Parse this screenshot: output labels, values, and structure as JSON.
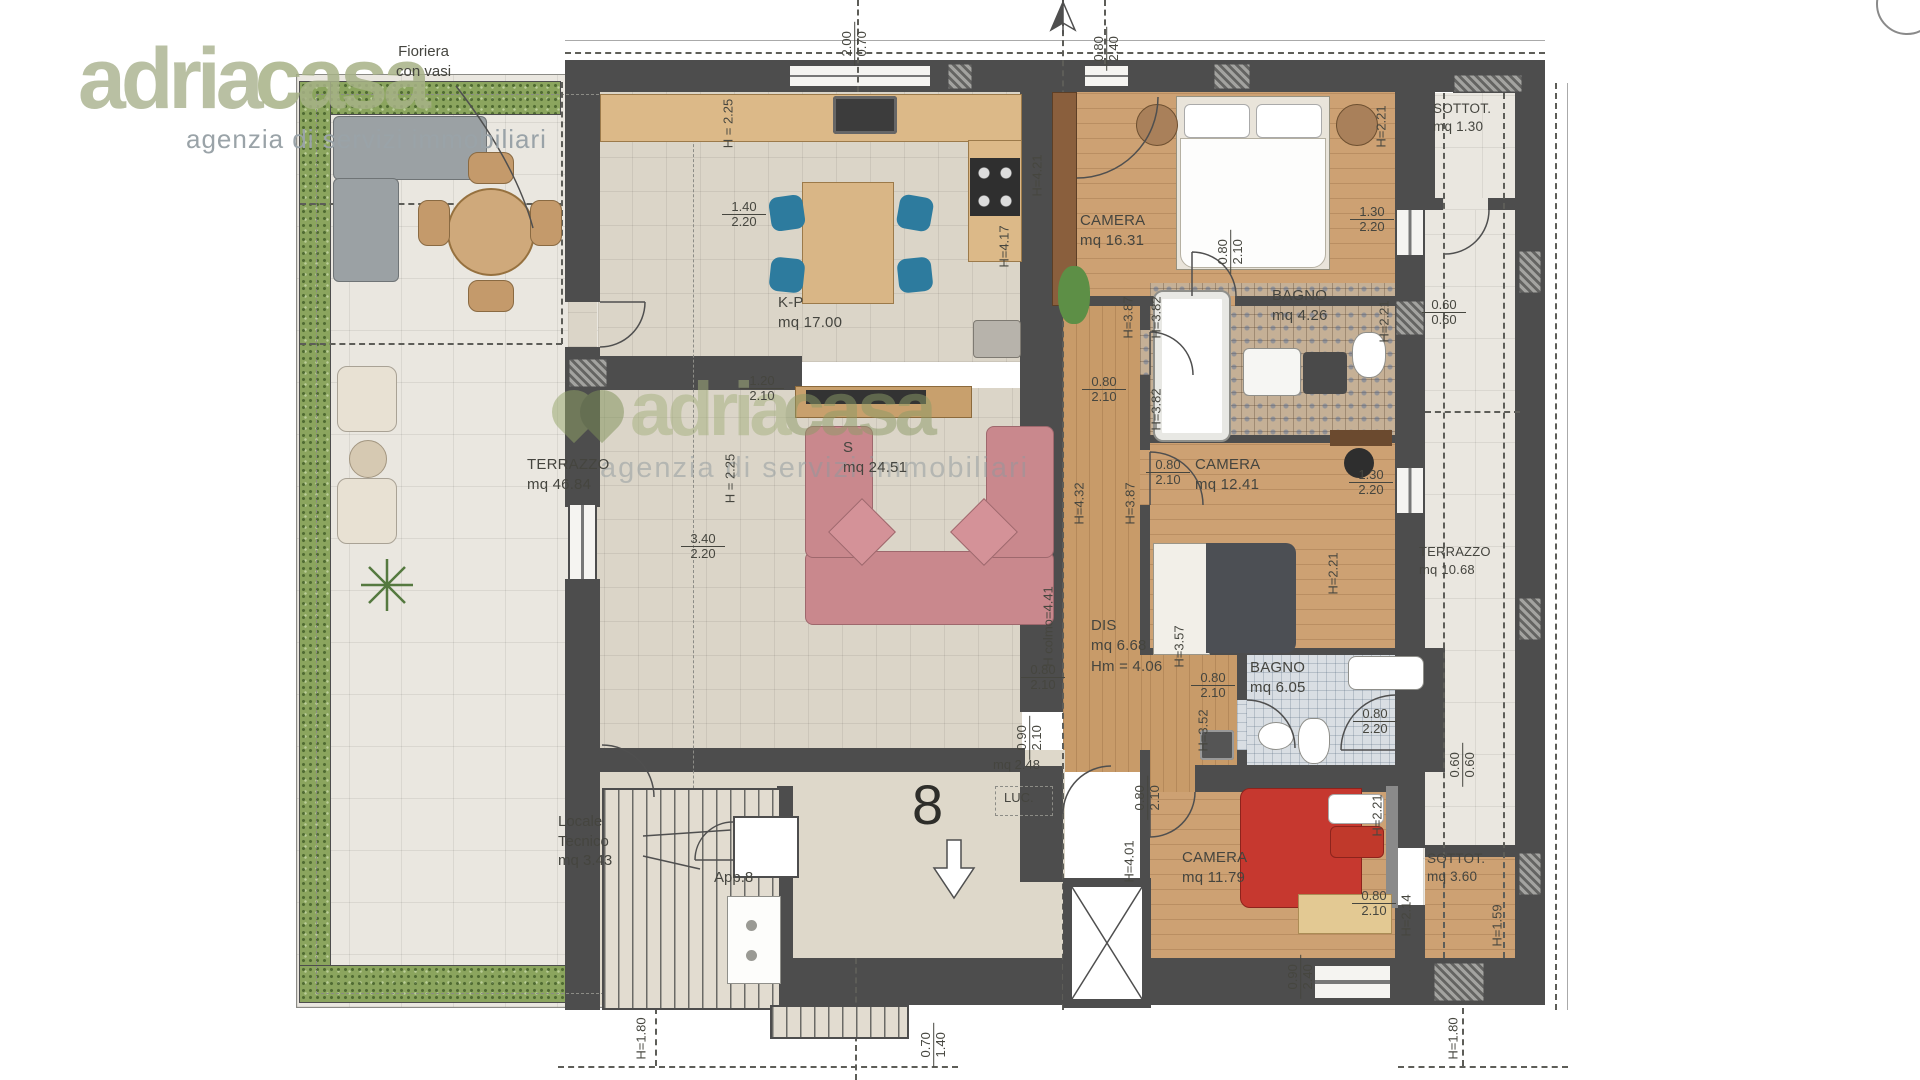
{
  "brand": {
    "name_primary": "adria",
    "name_secondary": "casa",
    "tagline": "agenzia di servizi immobiliari"
  },
  "plan": {
    "unit_number": "8",
    "rooms": {
      "terrazzo_left": {
        "name": "TERRAZZO",
        "area": "mq 46.84"
      },
      "kitchen": {
        "name": "K-P",
        "area": "mq 17.00"
      },
      "living": {
        "name": "S",
        "area": "mq 24.51"
      },
      "camera1": {
        "name": "CAMERA",
        "area": "mq 16.31"
      },
      "bagno1": {
        "name": "BAGNO",
        "area": "mq 4.26"
      },
      "sottotetto1": {
        "name": "SOTTOT.",
        "area": "mq 1.30"
      },
      "terrazzo_right": {
        "name": "TERRAZZO",
        "area": "mq 10.68"
      },
      "camera2": {
        "name": "CAMERA",
        "area": "mq 12.41"
      },
      "disimpegno": {
        "name": "DIS",
        "area": "mq 6.68",
        "height": "Hm = 4.06"
      },
      "bagno2": {
        "name": "BAGNO",
        "area": "mq 6.05"
      },
      "camera3": {
        "name": "CAMERA",
        "area": "mq 11.79"
      },
      "sottotetto2": {
        "name": "SOTTOT.",
        "area": "mq 3.60"
      }
    },
    "annotations": {
      "planter_line1": "Fioriera",
      "planter_line2": "con vasi",
      "tech_line1": "Locale",
      "tech_line2": "Tecnico",
      "tech_area": "mq 3.43",
      "apartment_ref": "App.8",
      "skylight": "LUC.",
      "stair_landing_area": "mq 2.48"
    },
    "dims": {
      "d1": {
        "a": "2.00",
        "b": "0.70"
      },
      "d2": {
        "a": "0.80",
        "b": "2.40"
      },
      "d3": {
        "a": "1.40",
        "b": "2.20"
      },
      "d4": {
        "a": "1.20",
        "b": "2.10"
      },
      "d5": {
        "a": "3.40",
        "b": "2.20"
      },
      "d6": {
        "a": "0.80",
        "b": "2.10"
      },
      "d7": {
        "a": "1.30",
        "b": "2.20"
      },
      "d8": {
        "a": "0.60",
        "b": "0.60"
      },
      "d9": {
        "a": "0.80",
        "b": "2.10"
      },
      "d10": {
        "a": "0.80",
        "b": "2.10"
      },
      "d11": {
        "a": "1.30",
        "b": "2.20"
      },
      "d12": {
        "a": "0.80",
        "b": "2.10"
      },
      "d13": {
        "a": "0.80",
        "b": "2.10"
      },
      "d14": {
        "a": "0.80",
        "b": "2.20"
      },
      "d15": {
        "a": "0.60",
        "b": "0.60"
      },
      "d16": {
        "a": "0.90",
        "b": "2.10"
      },
      "d17": {
        "a": "0.80",
        "b": "2.10"
      },
      "d18": {
        "a": "0.80",
        "b": "2.10"
      },
      "d19": {
        "a": "0.90",
        "b": "2.40"
      },
      "d20": {
        "a": "0.70",
        "b": "1.40"
      }
    },
    "heights": {
      "h1": "H = 2.25",
      "h2": "H = 2.25",
      "h3": "H=4.21",
      "h4": "H=4.17",
      "h5": "H=3.87",
      "h6": "H=3.82",
      "h7": "H=3.82",
      "h8": "H=4.32",
      "h9": "H=3.87",
      "h10": "H=2.21",
      "h11": "H=2.21",
      "h12": "H=2.21",
      "h13": "H=2.21",
      "h14": "H colmo=4.41",
      "h15": "H=3.57",
      "h16": "H=3.52",
      "h17": "H=4.01",
      "h18": "H=2.14",
      "h19": "H=1.59",
      "h20": "H=1.80",
      "h21": "H=1.80"
    }
  },
  "colors": {
    "logo_green": "#aab388",
    "wall": "#4d4d4d",
    "wood": "#cda173"
  }
}
